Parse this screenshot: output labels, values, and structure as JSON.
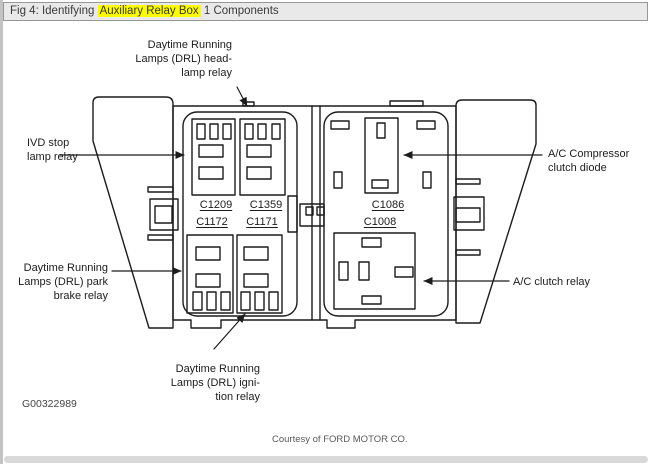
{
  "window": {
    "title_prefix": "Fig 4: Identifying ",
    "title_highlight": "Auxiliary Relay Box",
    "title_suffix": " 1 Components"
  },
  "diagram": {
    "figure_id": "G00322989",
    "courtesy": "Courtesy of FORD MOTOR CO.",
    "callouts": {
      "drl_headlamp": "Daytime Running\nLamps (DRL) head-\nlamp relay",
      "ivd_stop": "IVD stop\nlamp relay",
      "drl_park_brake": "Daytime Running\nLamps (DRL) park\nbrake relay",
      "drl_ignition": "Daytime Running\nLamps (DRL) igni-\ntion relay",
      "ac_compressor_diode": "A/C Compressor\nclutch diode",
      "ac_clutch_relay": "A/C clutch relay"
    },
    "connectors": {
      "c1209": "C1209",
      "c1359": "C1359",
      "c1172": "C1172",
      "c1171": "C1171",
      "c1086": "C1086",
      "c1008": "C1008"
    }
  },
  "colors": {
    "highlight": "#ffff00",
    "line": "#1c1c1c",
    "titlebar_bg": "#e9e9e9"
  }
}
